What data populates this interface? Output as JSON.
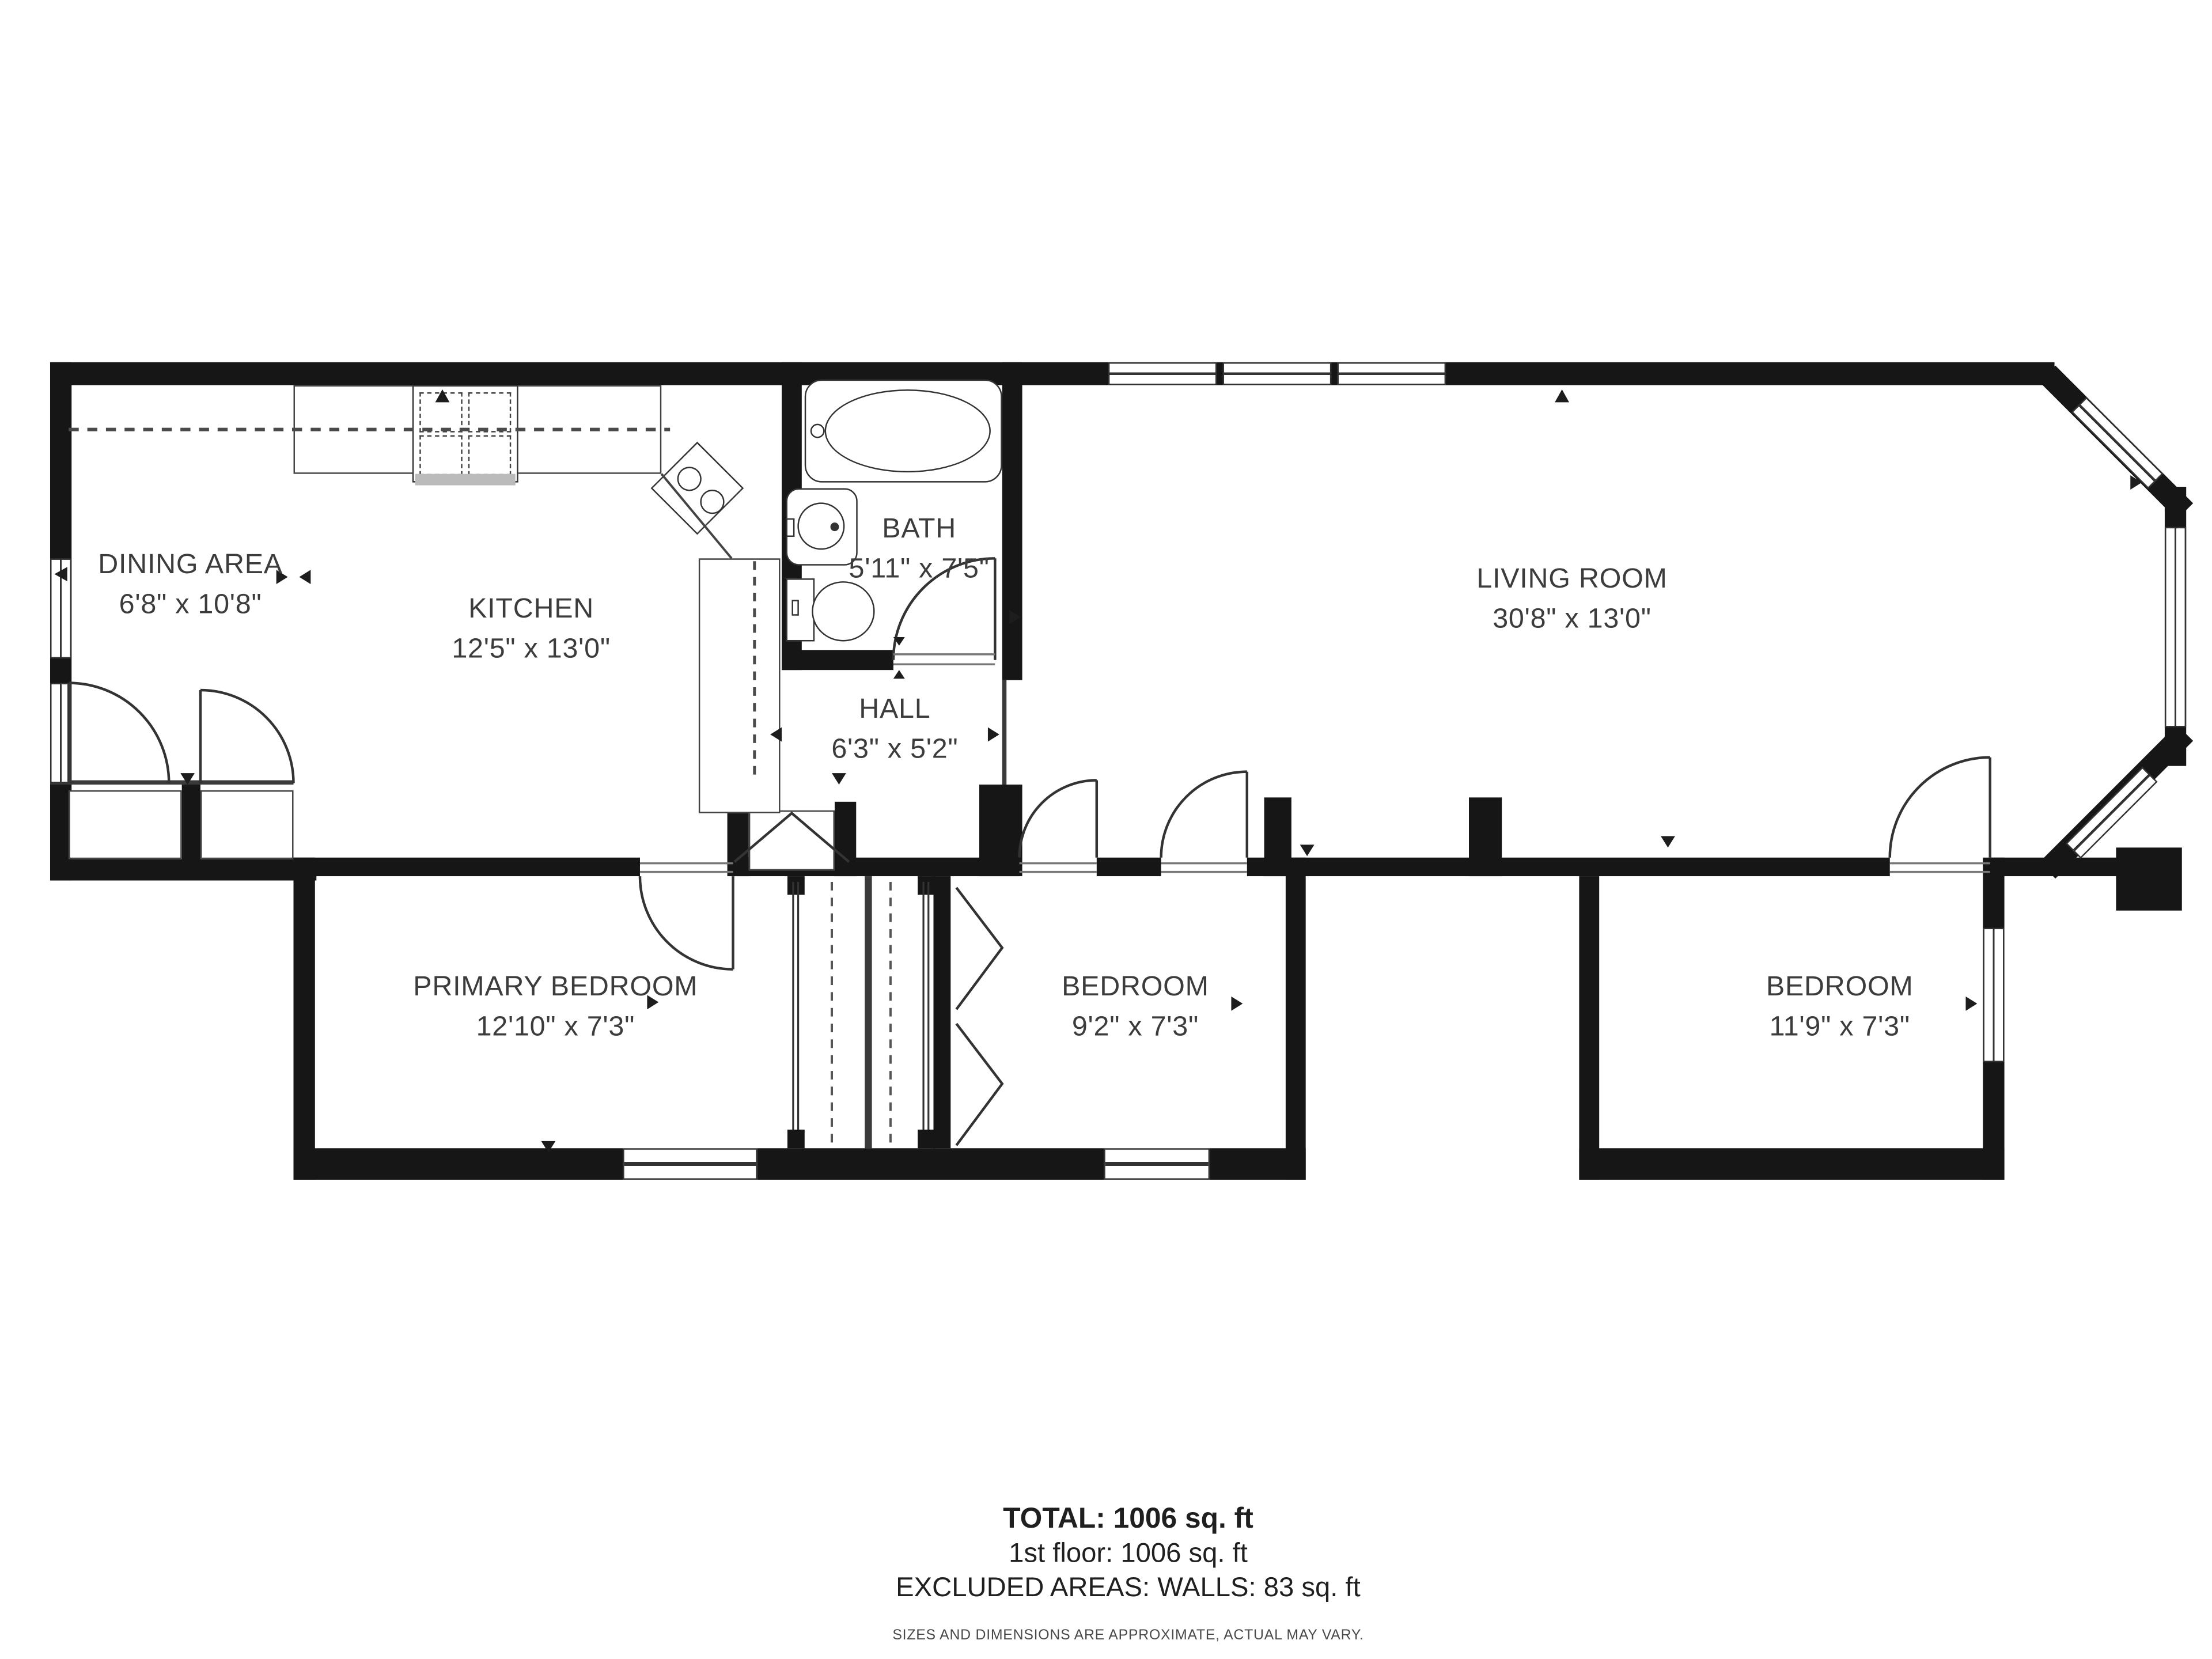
{
  "plan_title": "floor-plan",
  "rooms": [
    {
      "id": "dining",
      "name": "DINING AREA",
      "dims": "6'8\" x 10'8\""
    },
    {
      "id": "kitchen",
      "name": "KITCHEN",
      "dims": "12'5\" x 13'0\""
    },
    {
      "id": "bath",
      "name": "BATH",
      "dims": "5'11\" x 7'5\""
    },
    {
      "id": "hall",
      "name": "HALL",
      "dims": "6'3\" x 5'2\""
    },
    {
      "id": "living",
      "name": "LIVING ROOM",
      "dims": "30'8\" x 13'0\""
    },
    {
      "id": "primary",
      "name": "PRIMARY BEDROOM",
      "dims": "12'10\" x 7'3\""
    },
    {
      "id": "bedroom2",
      "name": "BEDROOM",
      "dims": "9'2\" x 7'3\""
    },
    {
      "id": "bedroom3",
      "name": "BEDROOM",
      "dims": "11'9\" x 7'3\""
    }
  ],
  "summary": {
    "total": "TOTAL: 1006 sq. ft",
    "floor": "1st floor: 1006 sq. ft",
    "excluded": "EXCLUDED AREAS: WALLS: 83 sq. ft",
    "disclaimer": "SIZES AND DIMENSIONS ARE APPROXIMATE, ACTUAL MAY VARY."
  }
}
